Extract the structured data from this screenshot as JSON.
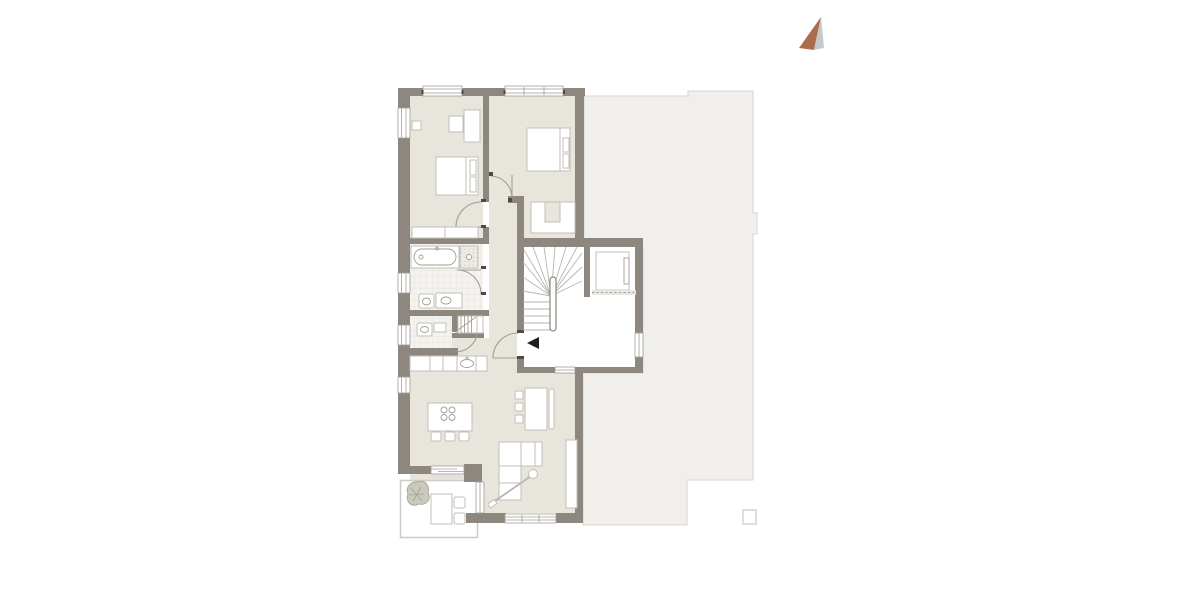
{
  "canvas": {
    "width": 1200,
    "height": 600,
    "background": "#ffffff"
  },
  "colors": {
    "wall": "#8d8780",
    "floor": "#e8e5dc",
    "tile": "#f4f3ef",
    "tileline": "#e2dfd9",
    "neighbor": "#f1efeb",
    "neighborline": "#d9d6d1",
    "furnline": "#c2bfb7",
    "thin": "#a29e96",
    "stair": "#b8b5ae",
    "jamb": "#4c4a46",
    "arrowbrown": "#ad6c4b",
    "arrowgray": "#c6c9cc",
    "black": "#1d1d1b",
    "plant": "#c9c9bd",
    "plantline": "#a3a396"
  },
  "icons": {
    "north_arrow": "two-tone north compass needle (terracotta left face, grey right face)",
    "entrance_arrow": "solid black triangle pointing left at apartment entry door",
    "column_marker": "small square outline below adjacent-building footprint"
  },
  "plan": {
    "type": "residential floor plan, no text labels",
    "rooms": [
      "bedroom-1",
      "bedroom-2",
      "closet-nook",
      "bathroom",
      "wc",
      "utility-closet",
      "corridor",
      "kitchen-living-dining",
      "stairwell",
      "elevator",
      "entrance-hall",
      "balcony"
    ],
    "fixtures": [
      "double-bed x2",
      "wardrobes",
      "bathtub",
      "shower",
      "toilets",
      "vanity",
      "kitchen-counter-with-sink",
      "island-with-cooktop",
      "bar-stools",
      "dining-table-with-chairs-and-bench",
      "l-shaped-sofa",
      "arc-floor-lamp",
      "sideboard",
      "balcony-table-chairs",
      "plant",
      "winder-staircase",
      "elevator-car"
    ]
  }
}
